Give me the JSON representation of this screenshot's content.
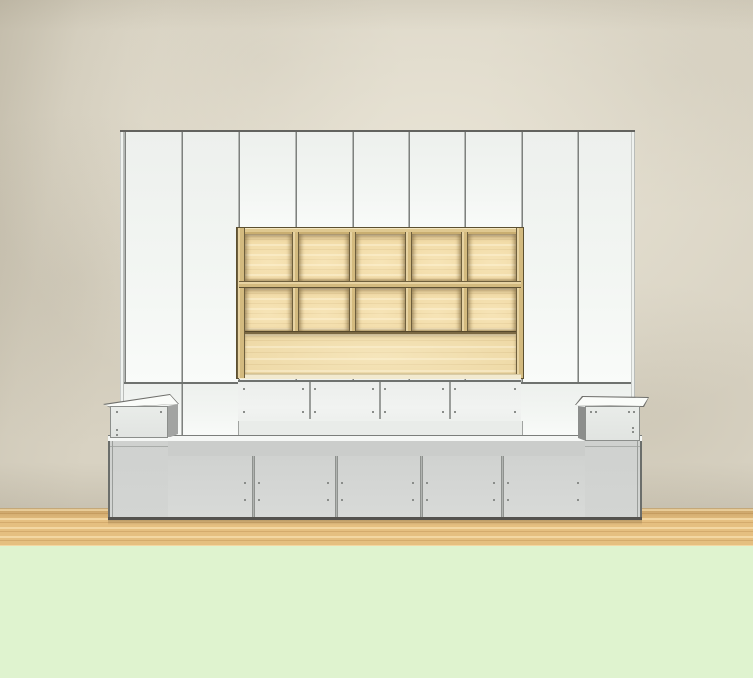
{
  "scene": {
    "kind": "3d-room-furniture-render",
    "visible_text": ""
  },
  "colors": {
    "wall_base": "#d8d2c2",
    "wall_shade": "#c6bfac",
    "wall_light": "#e6e0d0",
    "floor_wood": "#e5bf80",
    "floor_wood_light": "#f0d7a0",
    "floor_wood_dark": "#d9ad69",
    "floor_green": "#dff3cf",
    "panel_white": "#f1f4f1",
    "seam_gray": "#8d908d",
    "edge_dark": "#5f5f5b",
    "wood_cell": "#eed59d",
    "wood_frame": "#d3ba7f",
    "wood_frame_dark": "#6e5f3d",
    "wood_bottom_strip": "#f2ead0",
    "base_door_gray": "#d3d5d3",
    "base_rail_gray": "#cbcdcb",
    "base_bottom_dark": "#54524e",
    "box_top_white": "#fafcf9",
    "box_front_gray": "#e8ebe8",
    "box_side_dark": "#949694",
    "dot": "#8a8d8a"
  },
  "structure": {
    "wardrobe_tall_doors_left": 2,
    "wardrobe_upper_middle_doors": 5,
    "wardrobe_tall_doors_right": 2,
    "shelf_columns": 5,
    "shelf_rows": 2,
    "shelf_bottom_panel": 1,
    "drawer_fronts": 4,
    "base_doors": 5,
    "side_boxes": 2
  }
}
